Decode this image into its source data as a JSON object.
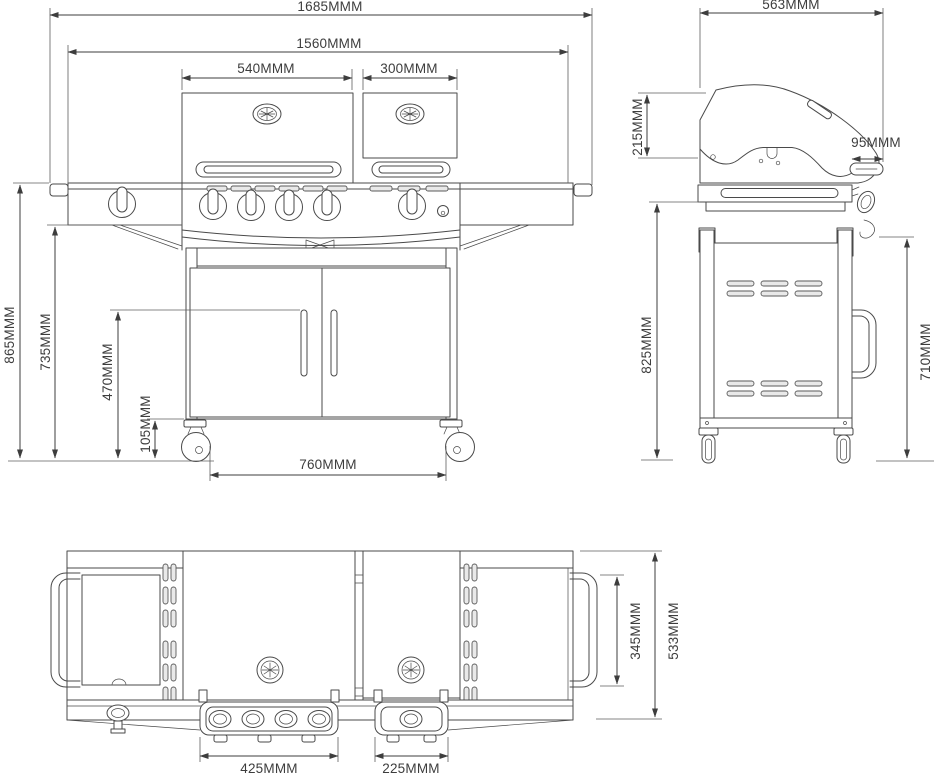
{
  "page": {
    "background_color": "#ffffff"
  },
  "drawing": {
    "line_color": "#4a4a4a",
    "dimension_color": "#3d3d3d",
    "unit_suffix": "MMM",
    "views": {
      "front": {
        "dims": {
          "overall_width": "1685MMM",
          "hood_span_width": "1560MMM",
          "main_lid_width": "540MMM",
          "side_lid_width": "300MMM",
          "overall_height": "865MMM",
          "worktop_height": "735MMM",
          "door_handle_height": "470MMM",
          "caster_height": "105MMM",
          "caster_track_width": "760MMM"
        }
      },
      "side": {
        "dims": {
          "overall_depth": "563MMM",
          "lid_height": "215MMM",
          "handle_depth": "95MMM",
          "worktop_height": "825MMM",
          "panel_height": "710MMM"
        }
      },
      "top": {
        "dims": {
          "main_knob_panel_width": "425MMM",
          "side_knob_panel_width": "225MMM",
          "shelf_handle_length": "345MMM",
          "overall_depth": "533MMM"
        }
      }
    }
  }
}
